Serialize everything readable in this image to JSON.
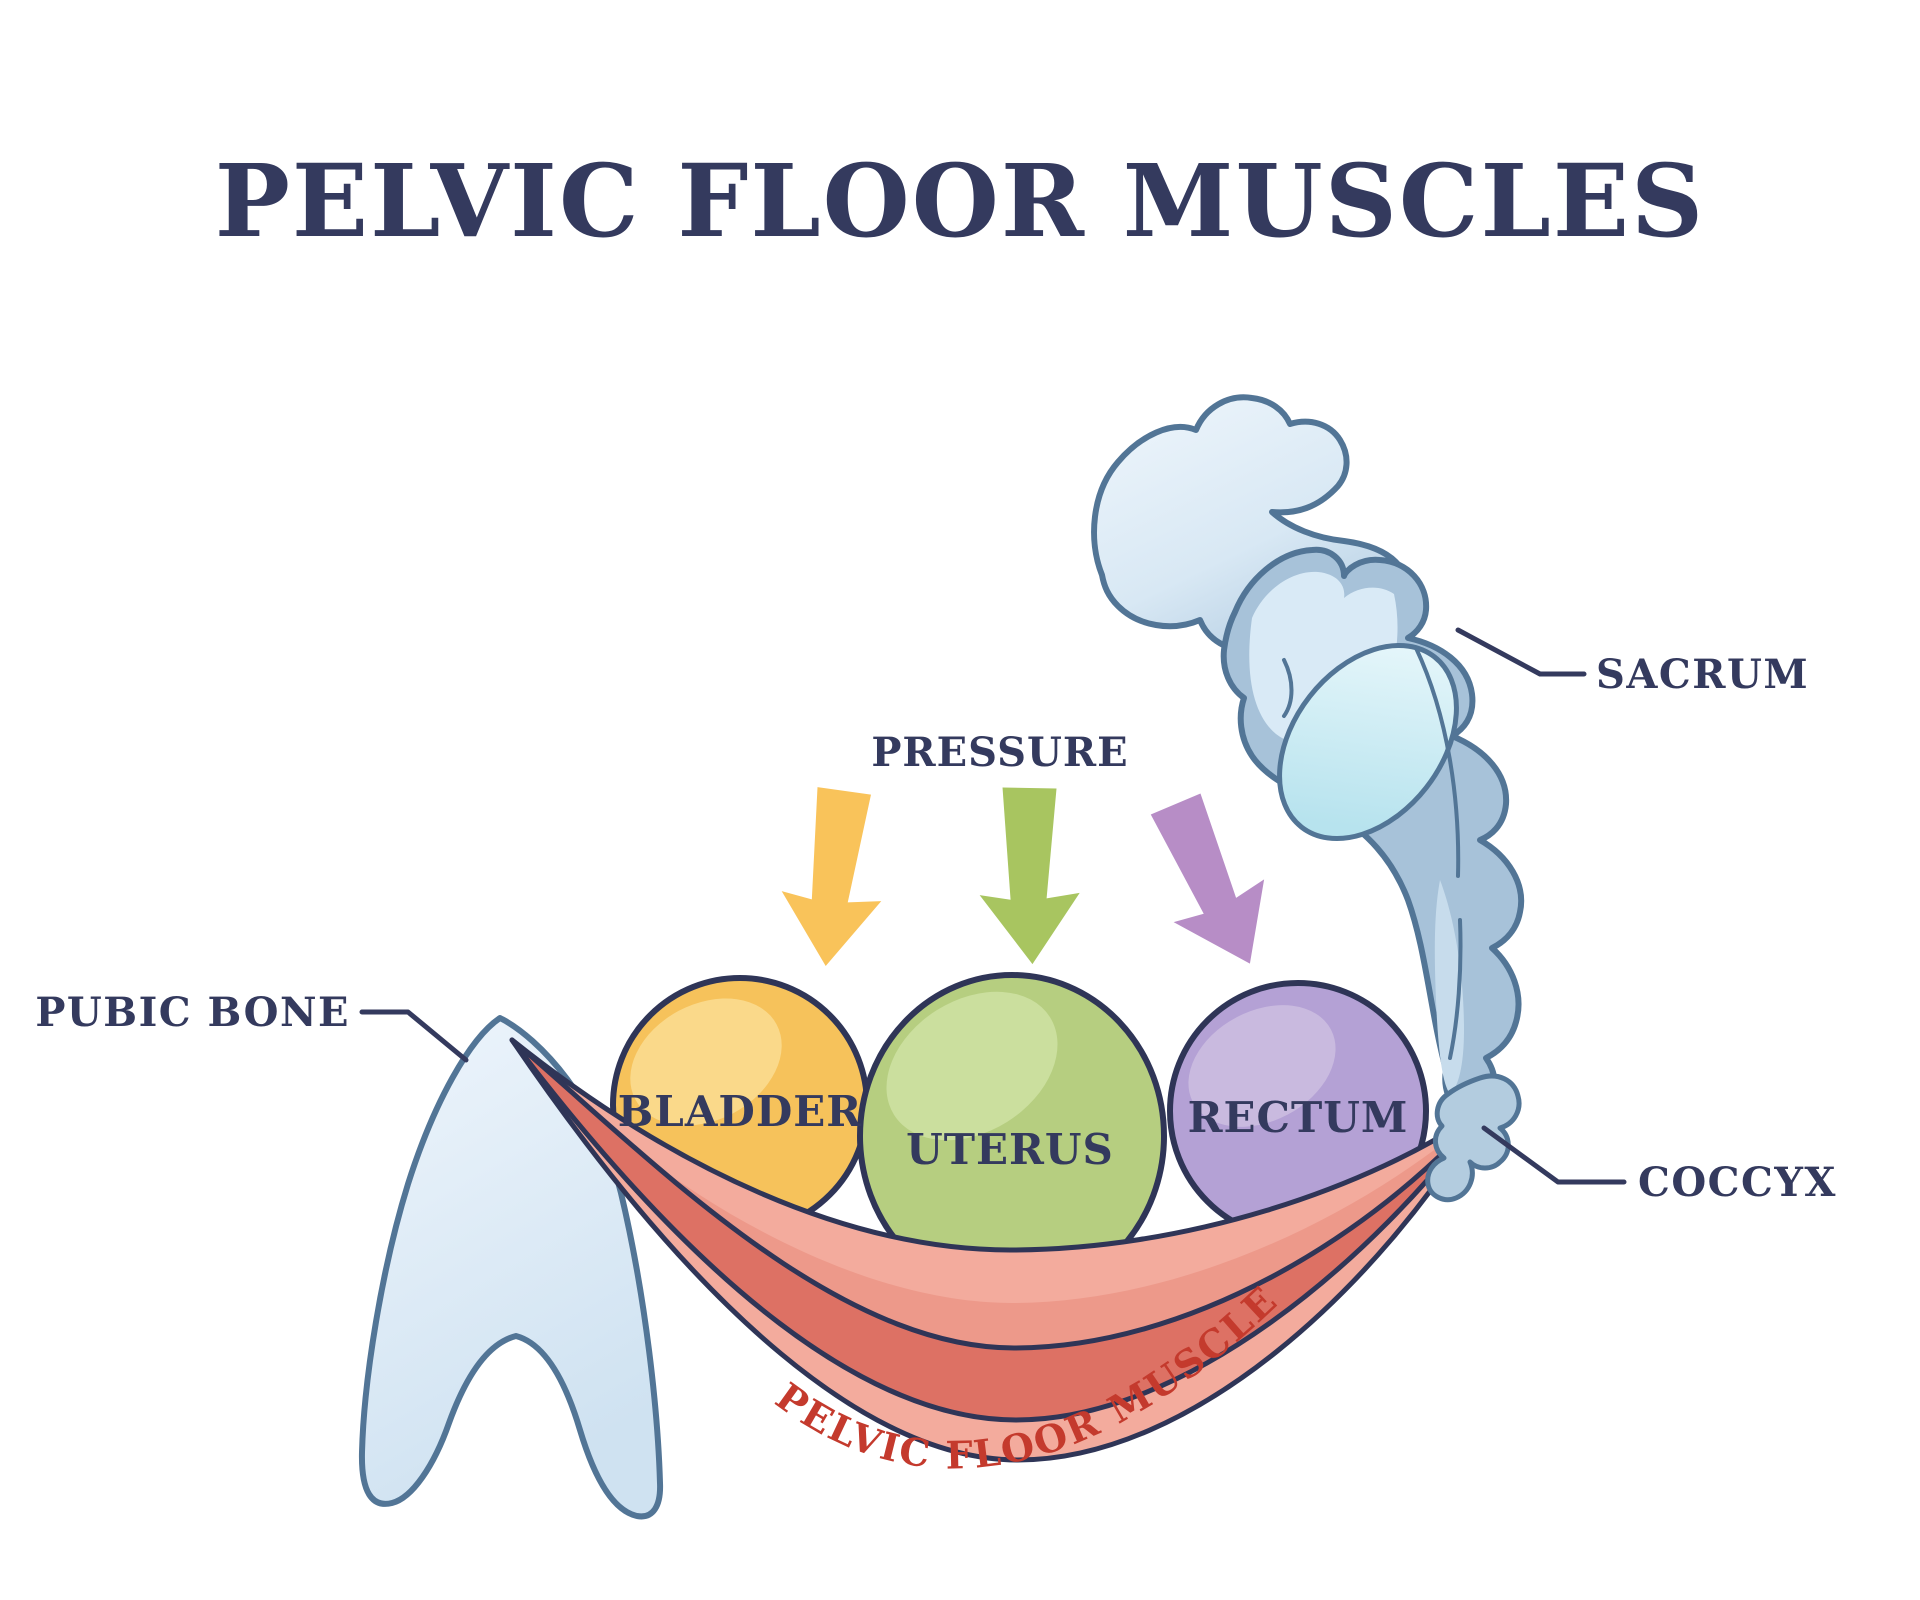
{
  "title": "PELVIC FLOOR MUSCLES",
  "labels": {
    "pressure": "PRESSURE",
    "pubic_bone": "PUBIC BONE",
    "sacrum": "SACRUM",
    "coccyx": "COCCYX",
    "bladder": "BLADDER",
    "uterus": "UTERUS",
    "rectum": "RECTUM",
    "pelvic_floor_muscles": "PELVIC FLOOR MUSCLES"
  },
  "colors": {
    "text_navy": "#343a5e",
    "outline_navy": "#2f3557",
    "red_label": "#c43a2d",
    "bladder": "#f6c25b",
    "bladder_light": "#fad98a",
    "uterus": "#b6ce80",
    "uterus_light": "#cbdf9e",
    "rectum": "#b4a1d5",
    "rectum_light": "#c9badf",
    "arrow_yellow": "#f9c35a",
    "arrow_green": "#a8c560",
    "arrow_purple": "#b78dc6",
    "muscle_light": "#f3ab9d",
    "muscle_mid": "#ed998a",
    "muscle_dark": "#dd7164",
    "bone_light": "#e3eef8",
    "bone_mid": "#bdd3e7",
    "bone_deep": "#a7c2d9",
    "bone_interior": "#d9eaf6",
    "coccyx_fill": "#b3ccdf",
    "sacrum_oval": "#cfeaf3",
    "bone_outline": "#527596"
  }
}
